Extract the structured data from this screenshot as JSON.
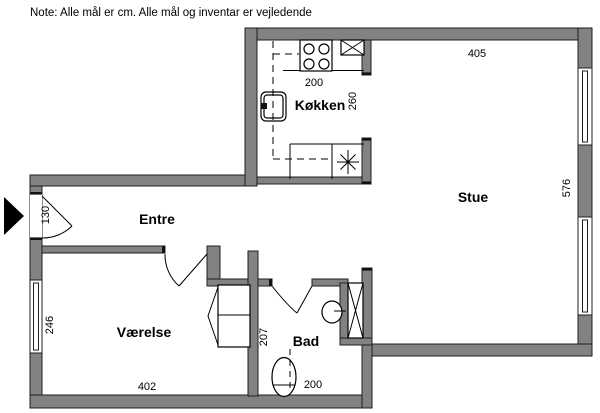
{
  "note": "Note: Alle mål er cm. Alle mål og inventar er vejledende",
  "colors": {
    "wall": "#828282",
    "line": "#000000",
    "background": "#ffffff"
  },
  "rooms": {
    "kitchen": {
      "name": "Køkken",
      "width": "200",
      "depth": "260"
    },
    "living": {
      "name": "Stue",
      "width": "405",
      "depth": "576"
    },
    "hall": {
      "name": "Entre",
      "entry_door_width": "130"
    },
    "bedroom": {
      "name": "Værelse",
      "width": "402",
      "depth": "246"
    },
    "bath": {
      "name": "Bad",
      "width": "200",
      "depth": "207"
    }
  },
  "icons": {
    "entry_arrow": "entrance-arrow-icon",
    "stove": "stove-4-burners-icon",
    "fridge": "appliance-x-icon",
    "kitchen_sink": "kitchen-sink-icon",
    "floor_drain": "asterisk-drain-icon",
    "shower": "shower-x-icon",
    "wash_basin": "wash-basin-icon",
    "toilet": "toilet-icon",
    "closet": "wardrobe-icon"
  }
}
